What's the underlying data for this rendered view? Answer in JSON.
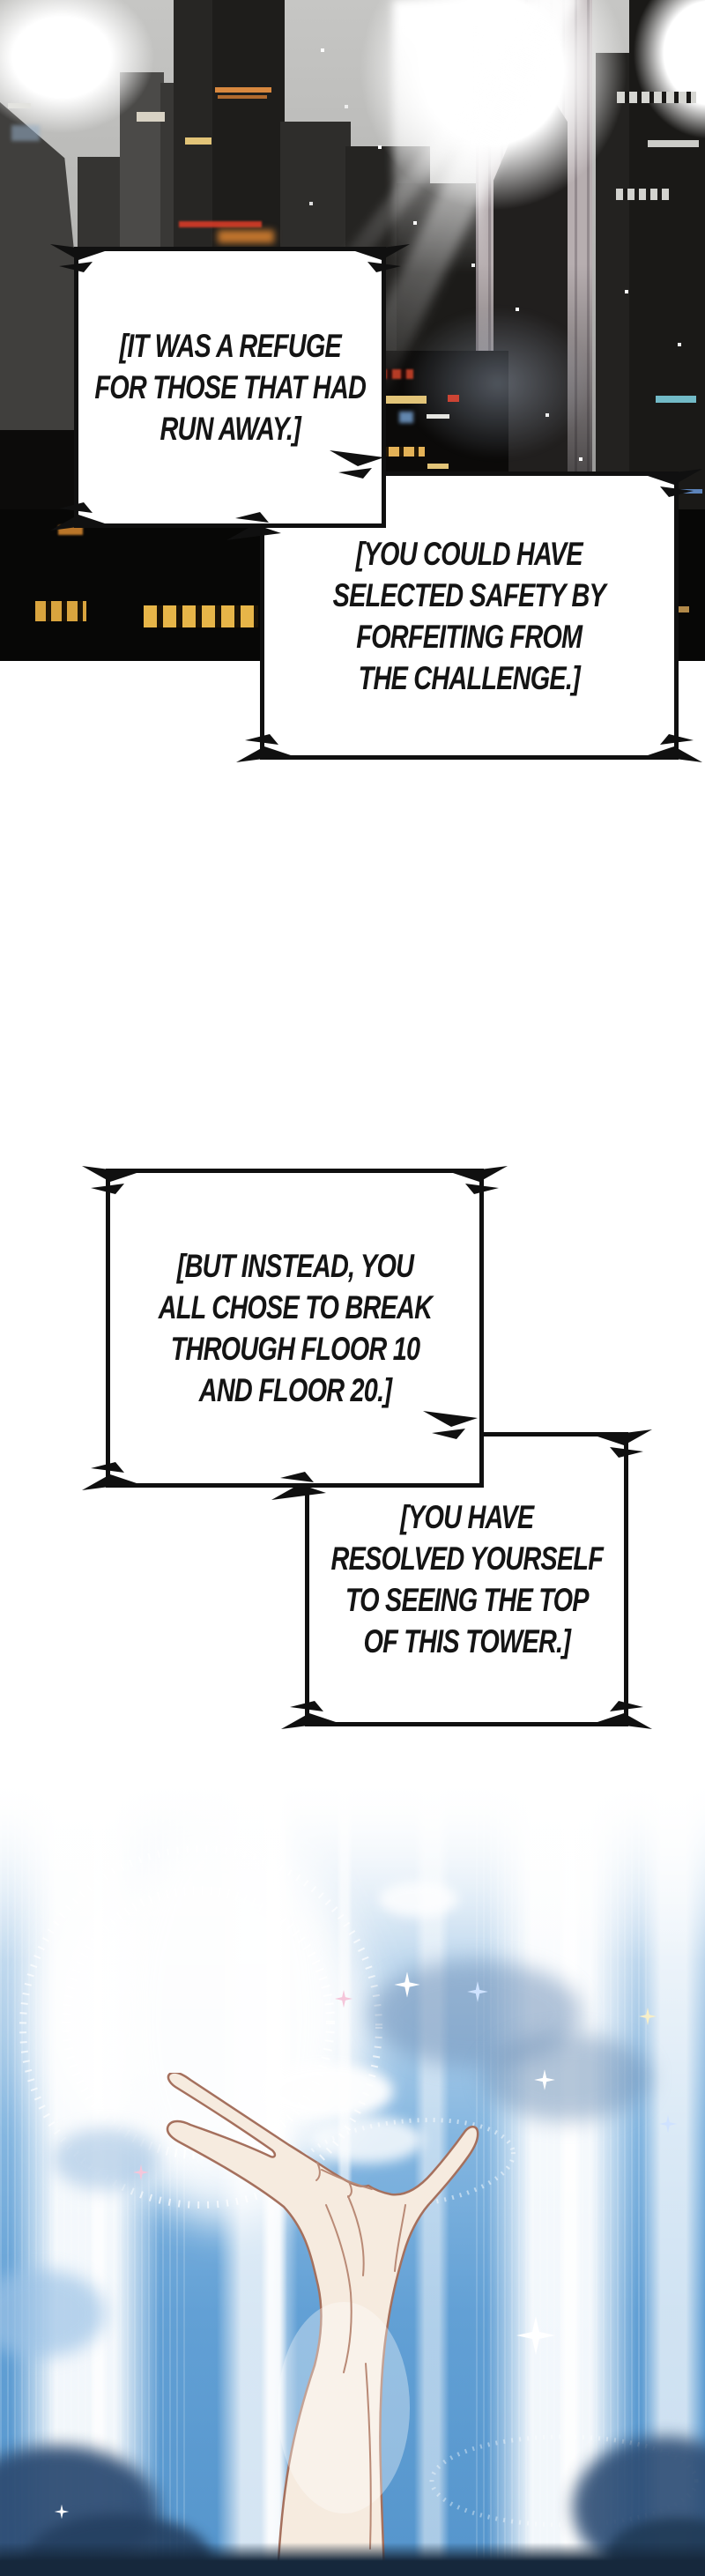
{
  "comic": {
    "boxes": [
      {
        "lines": [
          "[IT WAS A REFUGE",
          "FOR THOSE THAT HAD",
          "RUN AWAY.]"
        ]
      },
      {
        "lines": [
          "[YOU COULD HAVE",
          "SELECTED SAFETY BY",
          "FORFEITING FROM",
          "THE CHALLENGE.]"
        ]
      },
      {
        "lines": [
          "[BUT INSTEAD, YOU",
          "ALL CHOSE TO BREAK",
          "THROUGH FLOOR 10",
          "AND FLOOR 20.]"
        ]
      },
      {
        "lines": [
          "[YOU HAVE",
          "RESOLVED YOURSELF",
          "TO SEEING THE TOP",
          "OF THIS TOWER.]"
        ]
      }
    ],
    "colors": {
      "page_bg": "#ffffff",
      "box_border": "#101010",
      "box_fill": "#ffffff",
      "text": "#141414",
      "city_sky": "#b4b4b2",
      "city_building_dark": "#0b0a09",
      "window_warm": "#e7b548",
      "window_red": "#cc4434",
      "sky_blue": "#5595cc",
      "beam_white": "#ffffff",
      "cloud_navy": "#2e4d74",
      "skin": "#f6ebdf",
      "skin_outline": "#a5705d",
      "bottom_strip": "#16283c"
    }
  }
}
